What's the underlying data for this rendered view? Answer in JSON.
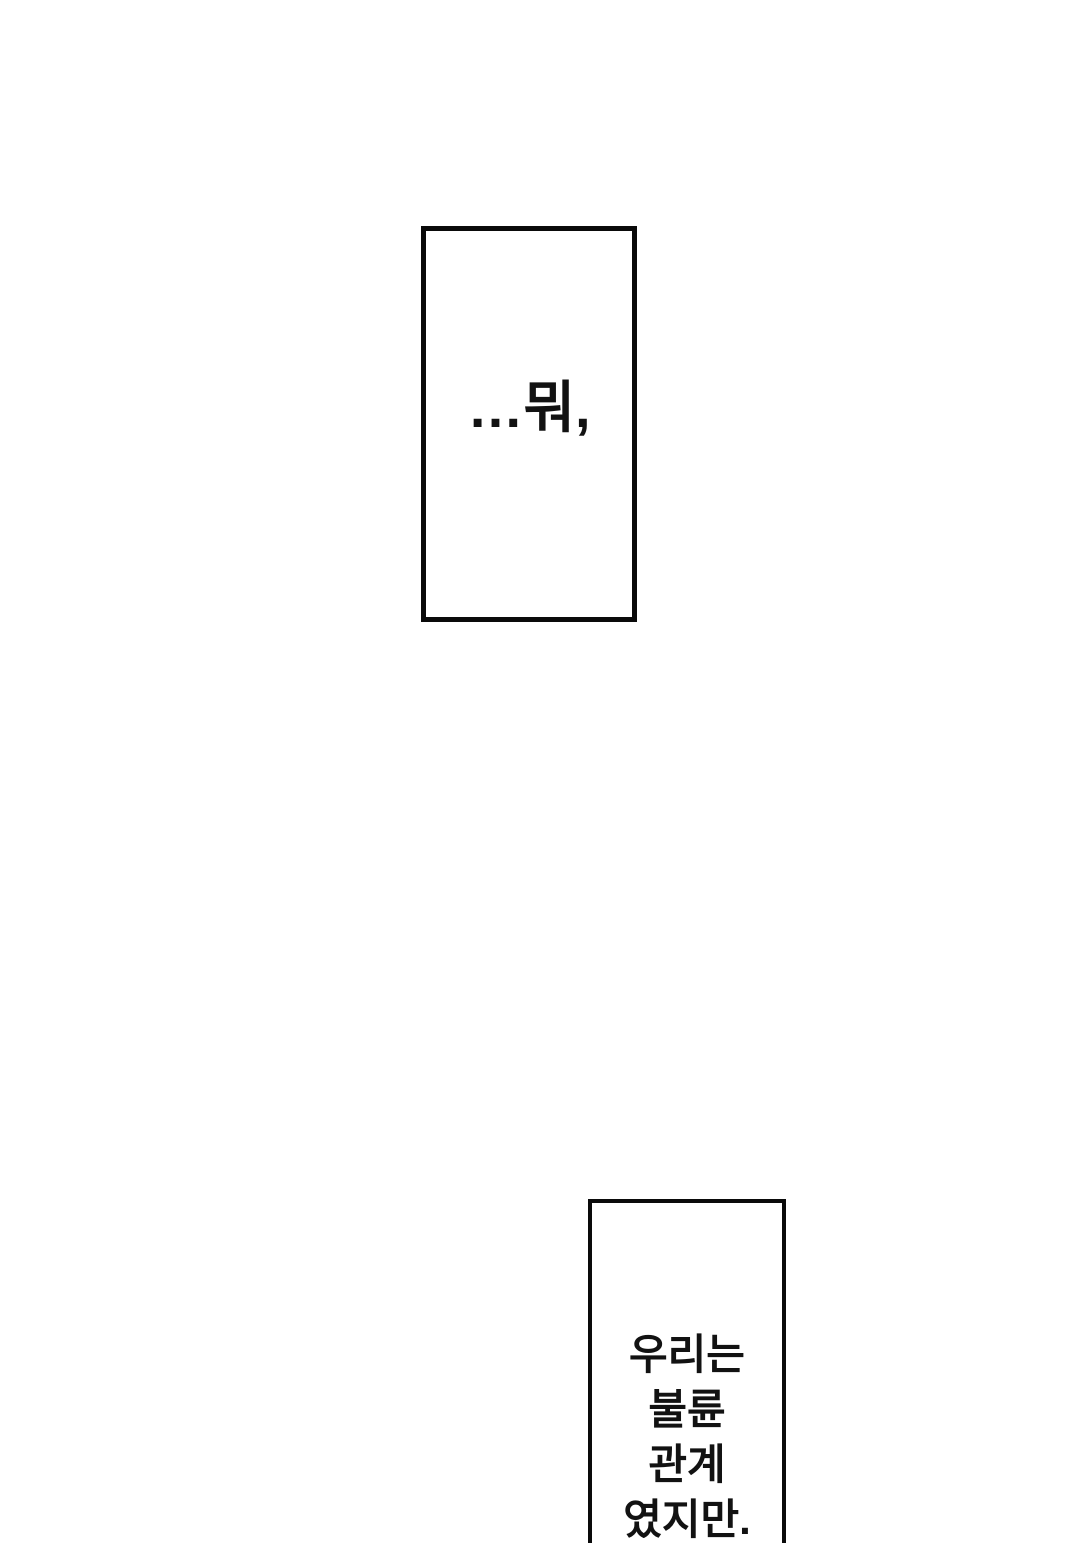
{
  "page": {
    "background_color": "#ffffff"
  },
  "panels": [
    {
      "id": "caption-panel-top",
      "type": "caption-box",
      "text": "…뭐,",
      "border_color": "#0a0a0a",
      "fill_color": "#ffffff",
      "text_color": "#121212"
    },
    {
      "id": "caption-panel-bottom",
      "type": "caption-box",
      "lines": [
        "우리는",
        "불륜",
        "관계",
        "였지만."
      ],
      "border_color": "#0a0a0a",
      "fill_color": "#ffffff",
      "text_color": "#121212",
      "clipped_at_bottom": true
    }
  ]
}
